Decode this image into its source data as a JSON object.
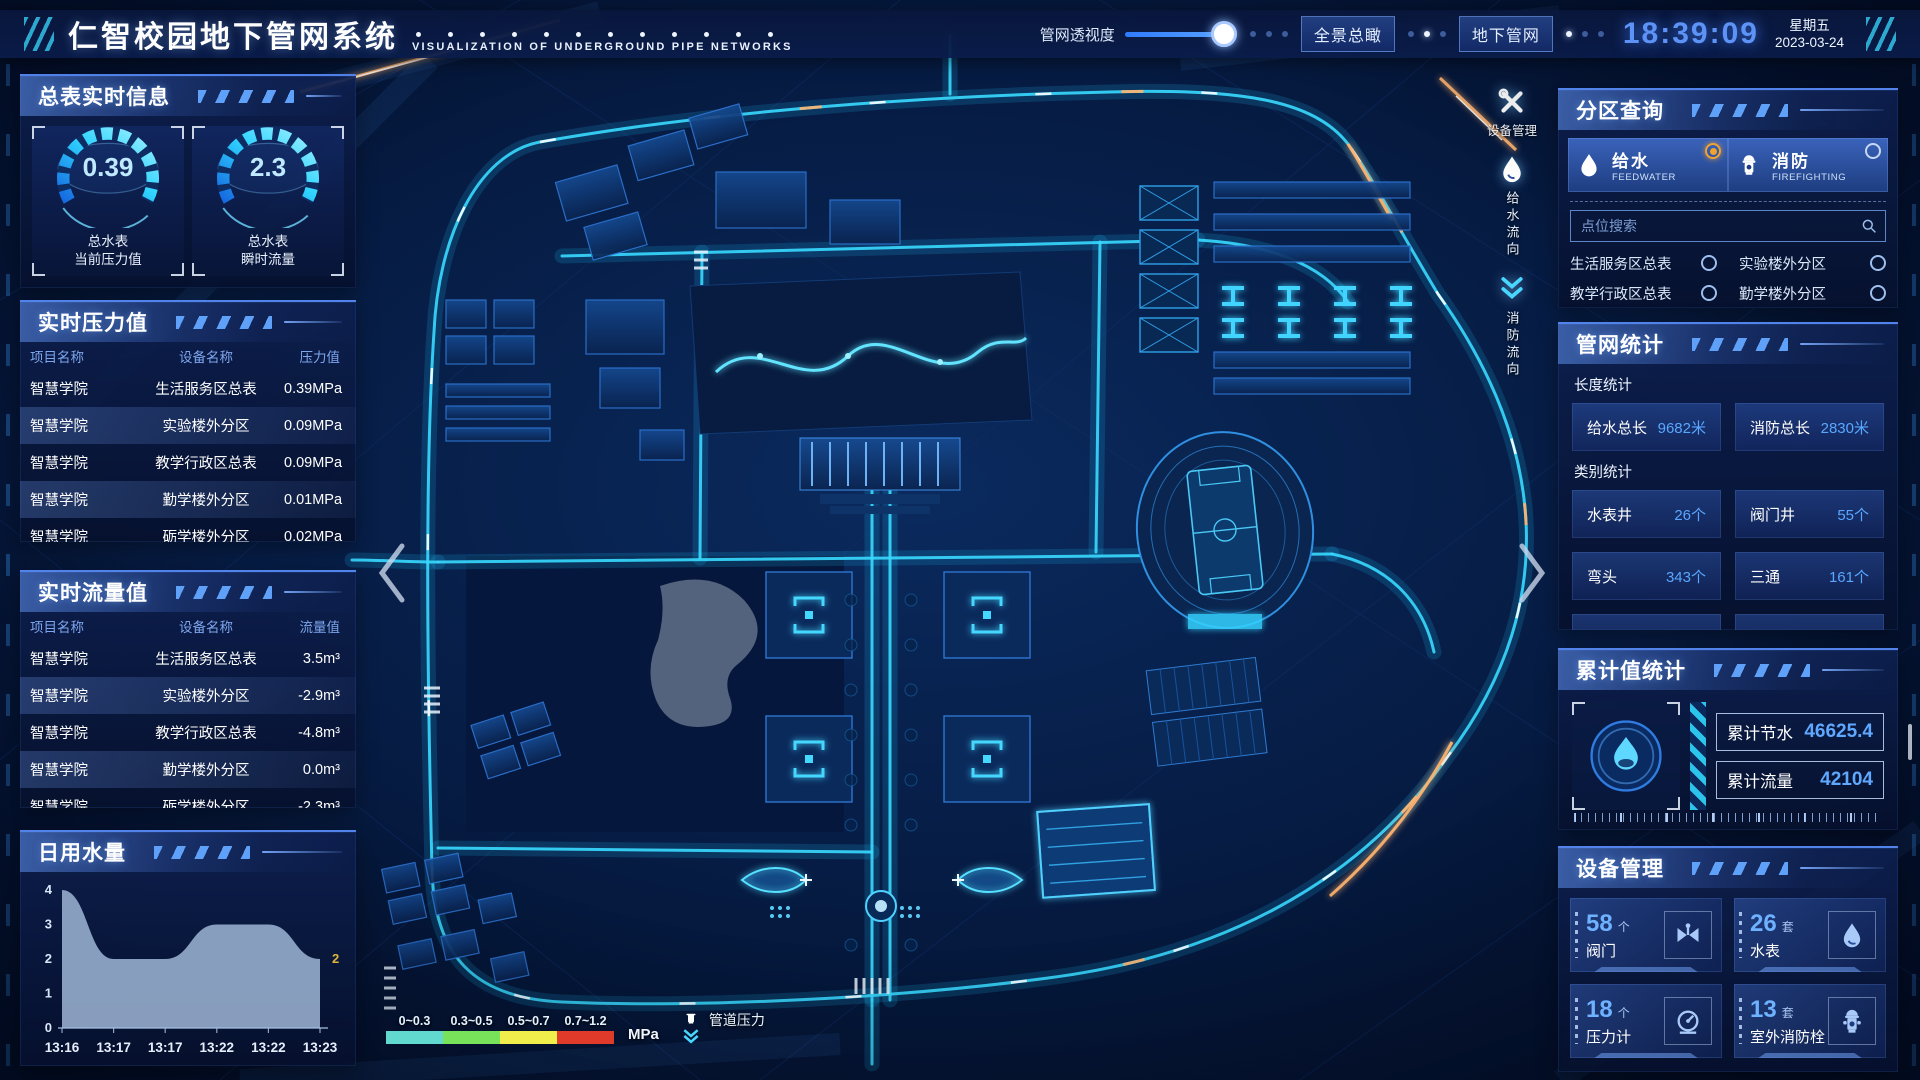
{
  "header": {
    "title_cn": "仁智校园地下管网系统",
    "title_en": "VISUALIZATION OF UNDERGROUND PIPE NETWORKS",
    "perspective_label": "管网透视度",
    "perspective_value": 86,
    "buttons": {
      "overview": "全景总瞰",
      "underground": "地下管网"
    },
    "clock": {
      "time": "18:39:09",
      "weekday": "星期五",
      "date": "2023-03-24"
    }
  },
  "meters_panel": {
    "title": "总表实时信息",
    "gauges": [
      {
        "value": "0.39",
        "line1": "总水表",
        "line2": "当前压力值"
      },
      {
        "value": "2.3",
        "line1": "总水表",
        "line2": "瞬时流量"
      }
    ]
  },
  "pressure_panel": {
    "title": "实时压力值",
    "headers": {
      "project": "项目名称",
      "device": "设备名称",
      "value": "压力值"
    },
    "rows": [
      {
        "project": "智慧学院",
        "device": "生活服务区总表",
        "value": "0.39MPa"
      },
      {
        "project": "智慧学院",
        "device": "实验楼外分区",
        "value": "0.09MPa"
      },
      {
        "project": "智慧学院",
        "device": "教学行政区总表",
        "value": "0.09MPa"
      },
      {
        "project": "智慧学院",
        "device": "勤学楼外分区",
        "value": "0.01MPa"
      },
      {
        "project": "智慧学院",
        "device": "砺学楼外分区",
        "value": "0.02MPa"
      }
    ]
  },
  "flow_panel": {
    "title": "实时流量值",
    "headers": {
      "project": "项目名称",
      "device": "设备名称",
      "value": "流量值"
    },
    "rows": [
      {
        "project": "智慧学院",
        "device": "生活服务区总表",
        "value": "3.5m³"
      },
      {
        "project": "智慧学院",
        "device": "实验楼外分区",
        "value": "-2.9m³"
      },
      {
        "project": "智慧学院",
        "device": "教学行政区总表",
        "value": "-4.8m³"
      },
      {
        "project": "智慧学院",
        "device": "勤学楼外分区",
        "value": "0.0m³"
      },
      {
        "project": "智慧学院",
        "device": "砺学楼外分区",
        "value": "-2.3m³"
      }
    ]
  },
  "chart_data": {
    "type": "area",
    "title": "日用水量",
    "x": [
      "13:16",
      "13:17",
      "13:17",
      "13:22",
      "13:22",
      "13:23"
    ],
    "values": [
      4,
      2,
      2,
      3,
      3,
      2
    ],
    "ylim": [
      0,
      4
    ],
    "yticks": [
      0,
      1,
      2,
      3,
      4
    ],
    "end_label": "2",
    "fill_color": "#9fb6d6",
    "grid": false,
    "legend_position": "none"
  },
  "query_panel": {
    "title": "分区查询",
    "tabs": [
      {
        "label": "给水",
        "sub": "FEEDWATER",
        "icon": "water-drop-icon",
        "selected": true
      },
      {
        "label": "消防",
        "sub": "FIREFIGHTING",
        "icon": "hydrant-icon",
        "selected": false
      }
    ],
    "search_placeholder": "点位搜索",
    "options": [
      "生活服务区总表",
      "实验楼外分区",
      "教学行政区总表",
      "勤学楼外分区",
      "砺学楼外分区",
      "宿舍区泵房"
    ]
  },
  "stats_panel": {
    "title": "管网统计",
    "length_section": "长度统计",
    "length_items": [
      {
        "label": "给水总长",
        "value": "9682米"
      },
      {
        "label": "消防总长",
        "value": "2830米"
      }
    ],
    "category_section": "类别统计",
    "category_items": [
      {
        "label": "水表井",
        "value": "26个"
      },
      {
        "label": "阀门井",
        "value": "55个"
      },
      {
        "label": "弯头",
        "value": "343个"
      },
      {
        "label": "三通",
        "value": "161个"
      }
    ]
  },
  "cumulative_panel": {
    "title": "累计值统计",
    "rows": [
      {
        "label": "累计节水",
        "value": "46625.4"
      },
      {
        "label": "累计流量",
        "value": "42104"
      }
    ]
  },
  "device_panel": {
    "title": "设备管理",
    "cards": [
      {
        "count": "58",
        "unit": "个",
        "label": "阀门",
        "icon": "valve-icon"
      },
      {
        "count": "26",
        "unit": "套",
        "label": "水表",
        "icon": "water-meter-icon"
      },
      {
        "count": "18",
        "unit": "个",
        "label": "压力计",
        "icon": "pressure-gauge-icon"
      },
      {
        "count": "13",
        "unit": "套",
        "label": "室外消防栓",
        "icon": "hydrant-icon"
      }
    ]
  },
  "map_overlay": {
    "tools": [
      {
        "label": "设备管理",
        "icon": "tools-icon"
      },
      {
        "label": "给水流向",
        "icon": "water-drop-icon"
      },
      {
        "label": "消防流向",
        "icon": "flow-arrows-icon"
      }
    ],
    "legend": {
      "ranges": [
        {
          "label": "0~0.3",
          "color": "#62d9cf"
        },
        {
          "label": "0.3~0.5",
          "color": "#78e25b"
        },
        {
          "label": "0.5~0.7",
          "color": "#f0ee4a"
        },
        {
          "label": "0.7~1.2",
          "color": "#e03a2a"
        }
      ],
      "unit": "MPa",
      "pipe_label": "管道压力"
    }
  },
  "colors": {
    "accent": "#2f7bff",
    "cyan": "#39d9ff",
    "selected": "#f0a32f",
    "time": "#5d93f7"
  }
}
